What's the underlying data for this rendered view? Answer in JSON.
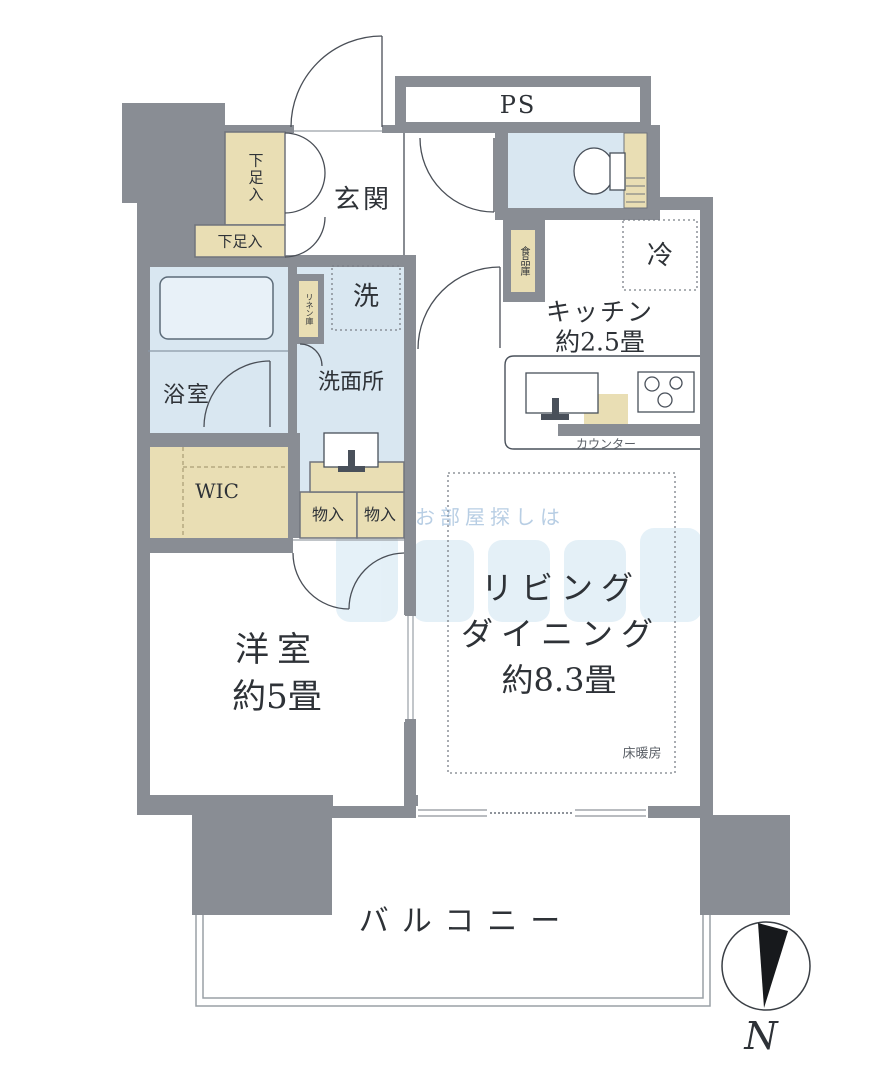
{
  "floorplan": {
    "type": "apartment-floor-plan",
    "orientation_mark": "N",
    "watermark": "お部屋探しは",
    "rooms": {
      "entrance": "玄関",
      "pipe_space": "PS",
      "shoe_cabinet_tall": "下足入",
      "shoe_cabinet_low": "下足入",
      "washer": "洗",
      "linen_closet": "リネン庫",
      "bathroom": "浴室",
      "washroom": "洗面所",
      "walk_in_closet": "WIC",
      "storage_1": "物入",
      "storage_2": "物入",
      "pantry": "食品庫",
      "fridge": "冷",
      "kitchen_line1": "キッチン",
      "kitchen_line2": "約2.5畳",
      "counter": "カウンター",
      "living_line1": "リビング",
      "living_line2": "ダイニング",
      "living_line3": "約8.3畳",
      "floor_heating": "床暖房",
      "bedroom_line1": "洋室",
      "bedroom_line2": "約5畳",
      "balcony": "バルコニー"
    },
    "sizes": {
      "kitchen_tatami": "約2.5畳",
      "living_dining_tatami": "約8.3畳",
      "bedroom_tatami": "約5畳"
    },
    "colors": {
      "wall": "#898d94",
      "wet_area": "#d9e7f1",
      "closet_area": "#e9deb4",
      "tub_fill": "#e8f1f8",
      "watermark_blue": "#a9cfe8",
      "compass_needle": "#17191c"
    }
  }
}
